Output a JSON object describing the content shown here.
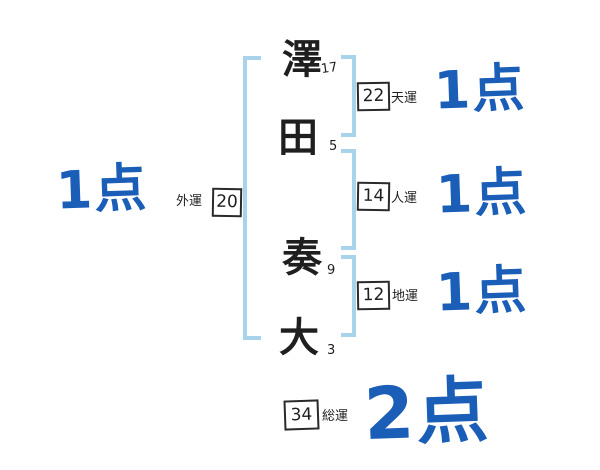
{
  "colors": {
    "score_blue": "#1b5eb8",
    "bracket_blue": "#a8d3ea",
    "ink": "#1f1f1f"
  },
  "name": {
    "characters": [
      {
        "char": "澤",
        "strokes": "17"
      },
      {
        "char": "田",
        "strokes": "5"
      },
      {
        "char": "奏",
        "strokes": "9"
      },
      {
        "char": "大",
        "strokes": "3"
      }
    ]
  },
  "fortunes": {
    "gaiun": {
      "label": "外運",
      "value": "20",
      "score": "1点"
    },
    "tenun": {
      "label": "天運",
      "value": "22",
      "score": "1点"
    },
    "jinun": {
      "label": "人運",
      "value": "14",
      "score": "1点"
    },
    "chiun": {
      "label": "地運",
      "value": "12",
      "score": "1点"
    },
    "souun": {
      "label": "総運",
      "value": "34",
      "score": "2点"
    }
  }
}
